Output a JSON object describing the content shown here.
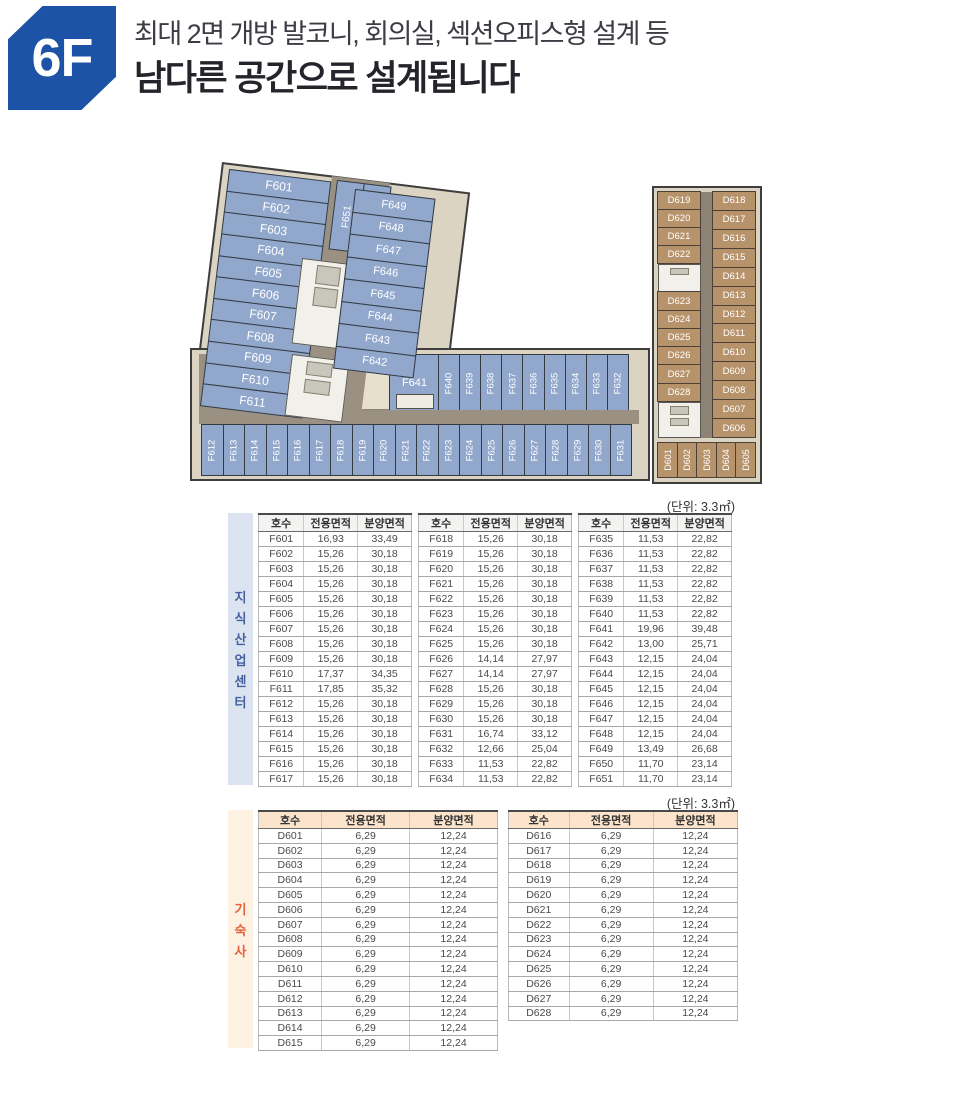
{
  "header": {
    "floor_badge": "6F",
    "subtitle": "최대 2면 개방 발코니, 회의실, 섹션오피스형 설계 등",
    "title": "남다른 공간으로 설계됩니다"
  },
  "unit_note": "(단위: 3.3㎡)",
  "colors": {
    "badge_blue": "#1c53a6",
    "unit_blue": "#91a7cb",
    "unit_tan": "#b7936c",
    "edge_tan": "#dcd4c3",
    "corridor": "#9b9183",
    "lblblue_bg": "#dce4f1",
    "lblblue_fg": "#44629f",
    "lblorange_bg": "#fdf1e2",
    "lblorange_fg": "#e55f3a",
    "hdr_peach": "#fbe4cb"
  },
  "floorplan_f": {
    "left_wing_units": [
      "F601",
      "F602",
      "F603",
      "F604",
      "F605",
      "F606",
      "F607",
      "F608",
      "F609",
      "F610",
      "F611"
    ],
    "top_center_units": [
      "F651",
      "F650"
    ],
    "right_wing_units": [
      "F649",
      "F648",
      "F647",
      "F646",
      "F645",
      "F644",
      "F643",
      "F642"
    ],
    "lower_units": [
      "F641"
    ],
    "lower_strip_units": [
      "F640",
      "F639",
      "F638",
      "F637",
      "F636",
      "F635",
      "F634",
      "F633",
      "F632"
    ],
    "bottom_row_units": [
      "F612",
      "F613",
      "F614",
      "F615",
      "F616",
      "F617",
      "F618",
      "F619",
      "F620",
      "F621",
      "F622",
      "F623",
      "F624",
      "F625",
      "F626",
      "F627",
      "F628",
      "F629",
      "F630",
      "F631"
    ]
  },
  "floorplan_d": {
    "left_col_top": [
      "D619",
      "D620",
      "D621",
      "D622"
    ],
    "left_col_bottom": [
      "D623",
      "D624",
      "D625",
      "D626",
      "D627",
      "D628"
    ],
    "right_col": [
      "D618",
      "D617",
      "D616",
      "D615",
      "D614",
      "D613",
      "D612",
      "D611",
      "D610",
      "D609",
      "D608",
      "D607",
      "D606"
    ],
    "bottom_row": [
      "D601",
      "D602",
      "D603",
      "D604",
      "D605"
    ]
  },
  "table_knowledge": {
    "side_label": "지식산업센터",
    "columns": [
      "호수",
      "전용면적",
      "분양면적"
    ],
    "group1": [
      [
        "F601",
        "16,93",
        "33,49"
      ],
      [
        "F602",
        "15,26",
        "30,18"
      ],
      [
        "F603",
        "15,26",
        "30,18"
      ],
      [
        "F604",
        "15,26",
        "30,18"
      ],
      [
        "F605",
        "15,26",
        "30,18"
      ],
      [
        "F606",
        "15,26",
        "30,18"
      ],
      [
        "F607",
        "15,26",
        "30,18"
      ],
      [
        "F608",
        "15,26",
        "30,18"
      ],
      [
        "F609",
        "15,26",
        "30,18"
      ],
      [
        "F610",
        "17,37",
        "34,35"
      ],
      [
        "F611",
        "17,85",
        "35,32"
      ],
      [
        "F612",
        "15,26",
        "30,18"
      ],
      [
        "F613",
        "15,26",
        "30,18"
      ],
      [
        "F614",
        "15,26",
        "30,18"
      ],
      [
        "F615",
        "15,26",
        "30,18"
      ],
      [
        "F616",
        "15,26",
        "30,18"
      ],
      [
        "F617",
        "15,26",
        "30,18"
      ]
    ],
    "group2": [
      [
        "F618",
        "15,26",
        "30,18"
      ],
      [
        "F619",
        "15,26",
        "30,18"
      ],
      [
        "F620",
        "15,26",
        "30,18"
      ],
      [
        "F621",
        "15,26",
        "30,18"
      ],
      [
        "F622",
        "15,26",
        "30,18"
      ],
      [
        "F623",
        "15,26",
        "30,18"
      ],
      [
        "F624",
        "15,26",
        "30,18"
      ],
      [
        "F625",
        "15,26",
        "30,18"
      ],
      [
        "F626",
        "14,14",
        "27,97"
      ],
      [
        "F627",
        "14,14",
        "27,97"
      ],
      [
        "F628",
        "15,26",
        "30,18"
      ],
      [
        "F629",
        "15,26",
        "30,18"
      ],
      [
        "F630",
        "15,26",
        "30,18"
      ],
      [
        "F631",
        "16,74",
        "33,12"
      ],
      [
        "F632",
        "12,66",
        "25,04"
      ],
      [
        "F633",
        "11,53",
        "22,82"
      ],
      [
        "F634",
        "11,53",
        "22,82"
      ]
    ],
    "group3": [
      [
        "F635",
        "11,53",
        "22,82"
      ],
      [
        "F636",
        "11,53",
        "22,82"
      ],
      [
        "F637",
        "11,53",
        "22,82"
      ],
      [
        "F638",
        "11,53",
        "22,82"
      ],
      [
        "F639",
        "11,53",
        "22,82"
      ],
      [
        "F640",
        "11,53",
        "22,82"
      ],
      [
        "F641",
        "19,96",
        "39,48"
      ],
      [
        "F642",
        "13,00",
        "25,71"
      ],
      [
        "F643",
        "12,15",
        "24,04"
      ],
      [
        "F644",
        "12,15",
        "24,04"
      ],
      [
        "F645",
        "12,15",
        "24,04"
      ],
      [
        "F646",
        "12,15",
        "24,04"
      ],
      [
        "F647",
        "12,15",
        "24,04"
      ],
      [
        "F648",
        "12,15",
        "24,04"
      ],
      [
        "F649",
        "13,49",
        "26,68"
      ],
      [
        "F650",
        "11,70",
        "23,14"
      ],
      [
        "F651",
        "11,70",
        "23,14"
      ]
    ]
  },
  "table_dorm": {
    "side_label": "기숙사",
    "columns": [
      "호수",
      "전용면적",
      "분양면적"
    ],
    "group1": [
      [
        "D601",
        "6,29",
        "12,24"
      ],
      [
        "D602",
        "6,29",
        "12,24"
      ],
      [
        "D603",
        "6,29",
        "12,24"
      ],
      [
        "D604",
        "6,29",
        "12,24"
      ],
      [
        "D605",
        "6,29",
        "12,24"
      ],
      [
        "D606",
        "6,29",
        "12,24"
      ],
      [
        "D607",
        "6,29",
        "12,24"
      ],
      [
        "D608",
        "6,29",
        "12,24"
      ],
      [
        "D609",
        "6,29",
        "12,24"
      ],
      [
        "D610",
        "6,29",
        "12,24"
      ],
      [
        "D611",
        "6,29",
        "12,24"
      ],
      [
        "D612",
        "6,29",
        "12,24"
      ],
      [
        "D613",
        "6,29",
        "12,24"
      ],
      [
        "D614",
        "6,29",
        "12,24"
      ],
      [
        "D615",
        "6,29",
        "12,24"
      ]
    ],
    "group2": [
      [
        "D616",
        "6,29",
        "12,24"
      ],
      [
        "D617",
        "6,29",
        "12,24"
      ],
      [
        "D618",
        "6,29",
        "12,24"
      ],
      [
        "D619",
        "6,29",
        "12,24"
      ],
      [
        "D620",
        "6,29",
        "12,24"
      ],
      [
        "D621",
        "6,29",
        "12,24"
      ],
      [
        "D622",
        "6,29",
        "12,24"
      ],
      [
        "D623",
        "6,29",
        "12,24"
      ],
      [
        "D624",
        "6,29",
        "12,24"
      ],
      [
        "D625",
        "6,29",
        "12,24"
      ],
      [
        "D626",
        "6,29",
        "12,24"
      ],
      [
        "D627",
        "6,29",
        "12,24"
      ],
      [
        "D628",
        "6,29",
        "12,24"
      ]
    ]
  }
}
